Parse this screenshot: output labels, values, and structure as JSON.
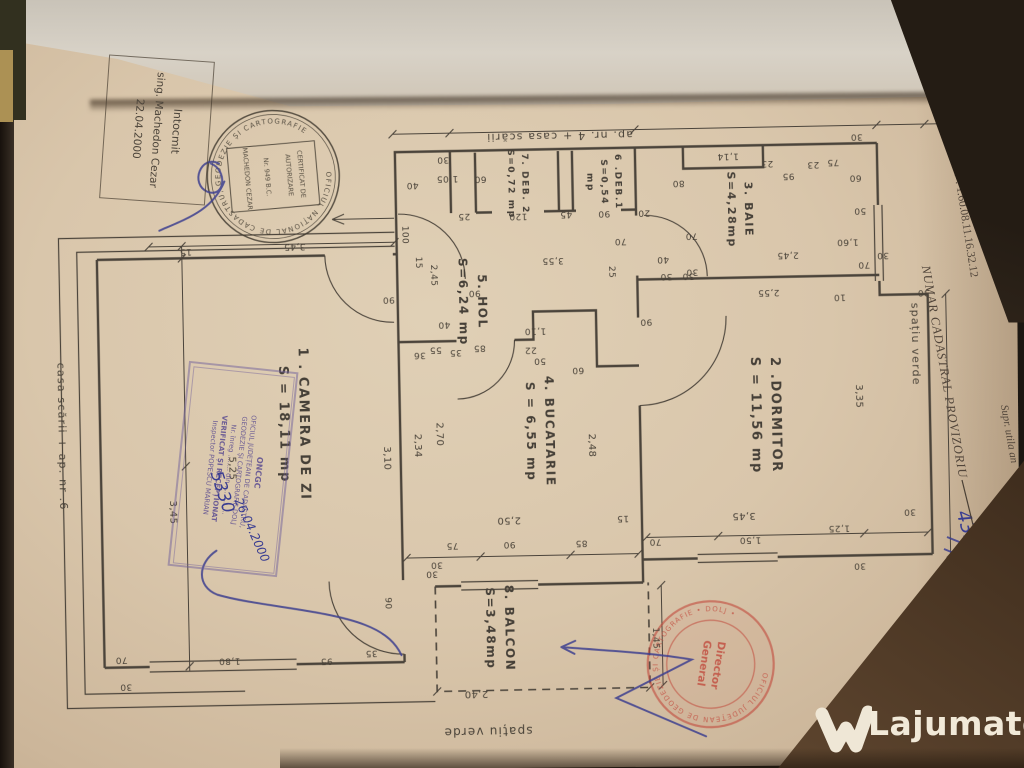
{
  "header": {
    "intocmit": {
      "line1": "Intocmit",
      "line2": "sing. Machedon Cezar",
      "line3": "22.04.2000"
    },
    "national_stamp": {
      "ring": "OFICIUL NAȚIONAL DE CADASTRU, GEODEZIE ȘI CARTOGRAFIE",
      "box_line1": "CERTIFICAT DE",
      "box_line2": "AUTORIZARE",
      "box_line3": "Nr. 949  B.C.",
      "box_line4": "MACHEDON CEZAR"
    },
    "proprietar": "Proprietar :   GIDEA S",
    "cnp": "C.N.P : 1.60.08.11.16.32.12",
    "numar_cadastral": "NUMAR CADASTRAL PROVIZORIU",
    "numar_value": "4329/1-5",
    "supr": "Supr. utila an"
  },
  "office_stamp": {
    "l1": "ONCGC",
    "l2": "OFICIUL JUDEȚEAN DE CADASTRU,",
    "l3": "GEODEZIE ȘI CARTOGRAFIE DOLJ",
    "l4": "Nr. înreg ........  din ..............",
    "l5": "VERIFICAT ȘI RECEPȚIONAT",
    "l6": "Inspector POPESCU MARIAN",
    "hand_nr": "5330",
    "hand_date": "26.04.2000"
  },
  "red_stamp": {
    "ring": "OFICIUL JUDEȚEAN DE GEODEZIE ȘI CARTOGRAFIE  •  DOLJ  •",
    "center1": "Director",
    "center2": "General"
  },
  "watermark": {
    "text": "Lajumate",
    "tld": ".ro"
  },
  "plan": {
    "rooms": [
      {
        "name": "1 . CAMERA  DE  ZI",
        "area": "S = 18,11 mp",
        "x": 293,
        "y": 420,
        "fs": 13
      },
      {
        "name": "2 .DORMITOR",
        "area": "S = 11,56 mp",
        "x": 765,
        "y": 420,
        "fs": 13
      },
      {
        "name": "3. BAIE",
        "area": "S=4,28mp",
        "x": 744,
        "y": 214,
        "fs": 11
      },
      {
        "name": "4. BUCATARIE",
        "area": "S = 6,55 mp",
        "x": 540,
        "y": 432,
        "fs": 12
      },
      {
        "name": "5. HOL",
        "area": "S=6,24 mp",
        "x": 475,
        "y": 301,
        "fs": 12
      },
      {
        "name": "6 .DEB.1",
        "area": "S=0,54",
        "extra": "mp",
        "x": 607,
        "y": 184,
        "fs": 9
      },
      {
        "name": "7. DEB. 2",
        "area": "S=0,72 mp",
        "x": 521,
        "y": 184,
        "fs": 9
      },
      {
        "name": "8. BALCON",
        "area": "S=3,48mp",
        "x": 496,
        "y": 628,
        "fs": 12
      }
    ],
    "outside": [
      {
        "t": "ap. nr. 4 + casa scării",
        "x": 565,
        "y": 137,
        "r": 180,
        "fs": 11
      },
      {
        "t": "casa scării + ap. nr .6",
        "x": 62,
        "y": 428,
        "r": 90,
        "fs": 11
      },
      {
        "t": "spațiu verde",
        "x": 917,
        "y": 352,
        "r": 90,
        "fs": 11
      },
      {
        "t": "spațiu verde",
        "x": 482,
        "y": 731,
        "r": 180,
        "fs": 12
      }
    ],
    "dims": [
      [
        "30",
        448,
        158,
        180
      ],
      [
        "1,05",
        452,
        177,
        180
      ],
      [
        "40",
        417,
        183,
        180
      ],
      [
        "60",
        485,
        178,
        180
      ],
      [
        "25",
        468,
        215,
        180
      ],
      [
        "120",
        522,
        216,
        180
      ],
      [
        "45",
        570,
        215,
        180
      ],
      [
        "90",
        608,
        215,
        180
      ],
      [
        "20",
        648,
        215,
        180
      ],
      [
        "80",
        683,
        186,
        180
      ],
      [
        "1,14",
        733,
        160,
        180
      ],
      [
        "23",
        772,
        168,
        180
      ],
      [
        "95",
        793,
        181,
        180
      ],
      [
        "23",
        818,
        170,
        180
      ],
      [
        "75",
        838,
        168,
        180
      ],
      [
        "60",
        860,
        184,
        180
      ],
      [
        "30",
        862,
        143,
        180
      ],
      [
        "50",
        864,
        217,
        180
      ],
      [
        "1,60",
        851,
        248,
        180
      ],
      [
        "70",
        867,
        271,
        180
      ],
      [
        "30",
        886,
        262,
        180
      ],
      [
        "30",
        926,
        300,
        180
      ],
      [
        "15",
        189,
        245,
        180
      ],
      [
        "3,45",
        298,
        242,
        180
      ],
      [
        "100",
        408,
        233,
        90
      ],
      [
        "15",
        421,
        261,
        90
      ],
      [
        "2,45",
        436,
        274,
        90
      ],
      [
        "3,55",
        556,
        261,
        180
      ],
      [
        "90",
        477,
        292,
        180
      ],
      [
        "85",
        481,
        347,
        180
      ],
      [
        "40",
        446,
        323,
        180
      ],
      [
        "55",
        437,
        348,
        180
      ],
      [
        "36",
        421,
        353,
        180
      ],
      [
        "35",
        457,
        351,
        180
      ],
      [
        "1,10",
        537,
        331,
        180
      ],
      [
        "22",
        532,
        350,
        180
      ],
      [
        "50",
        541,
        361,
        180
      ],
      [
        "60",
        579,
        371,
        180
      ],
      [
        "25",
        614,
        274,
        90
      ],
      [
        "70",
        624,
        243,
        180
      ],
      [
        "40",
        666,
        262,
        180
      ],
      [
        "30",
        669,
        279,
        180
      ],
      [
        "30",
        691,
        279,
        180
      ],
      [
        "90",
        648,
        324,
        180
      ],
      [
        "2,45",
        791,
        260,
        180
      ],
      [
        "70",
        695,
        239,
        180
      ],
      [
        "30",
        695,
        275,
        180
      ],
      [
        "2,55",
        771,
        297,
        180
      ],
      [
        "10",
        842,
        303,
        180
      ],
      [
        "3,35",
        859,
        403,
        90,
        10
      ],
      [
        "3,10",
        386,
        456,
        90,
        10
      ],
      [
        "90",
        391,
        297,
        180
      ],
      [
        "5,25",
        231,
        463,
        90,
        10
      ],
      [
        "3,45",
        171,
        506,
        90,
        10
      ],
      [
        "2,70",
        439,
        433,
        90,
        10
      ],
      [
        "2,34",
        417,
        444,
        90,
        10
      ],
      [
        "2,48",
        591,
        447,
        90,
        10
      ],
      [
        "2,50",
        507,
        520,
        180,
        10
      ],
      [
        "75",
        450,
        544,
        180
      ],
      [
        "90",
        507,
        544,
        180
      ],
      [
        "85",
        579,
        544,
        180
      ],
      [
        "30",
        434,
        563,
        180
      ],
      [
        "3,45",
        742,
        520,
        180,
        10
      ],
      [
        "15",
        621,
        520,
        180
      ],
      [
        "70",
        653,
        544,
        180
      ],
      [
        "1,50",
        748,
        544,
        180
      ],
      [
        "1,25",
        837,
        534,
        180
      ],
      [
        "30",
        908,
        519,
        180
      ],
      [
        "30",
        857,
        572,
        180
      ],
      [
        "70",
        117,
        652,
        180
      ],
      [
        "30",
        121,
        679,
        180
      ],
      [
        "1,80",
        225,
        655,
        180
      ],
      [
        "95",
        322,
        657,
        180
      ],
      [
        "35",
        367,
        650,
        180
      ],
      [
        "90",
        384,
        601,
        90
      ],
      [
        "1,45",
        651,
        641,
        90
      ],
      [
        "2,40",
        471,
        693,
        180,
        10
      ],
      [
        "30",
        429,
        572,
        180
      ]
    ]
  }
}
